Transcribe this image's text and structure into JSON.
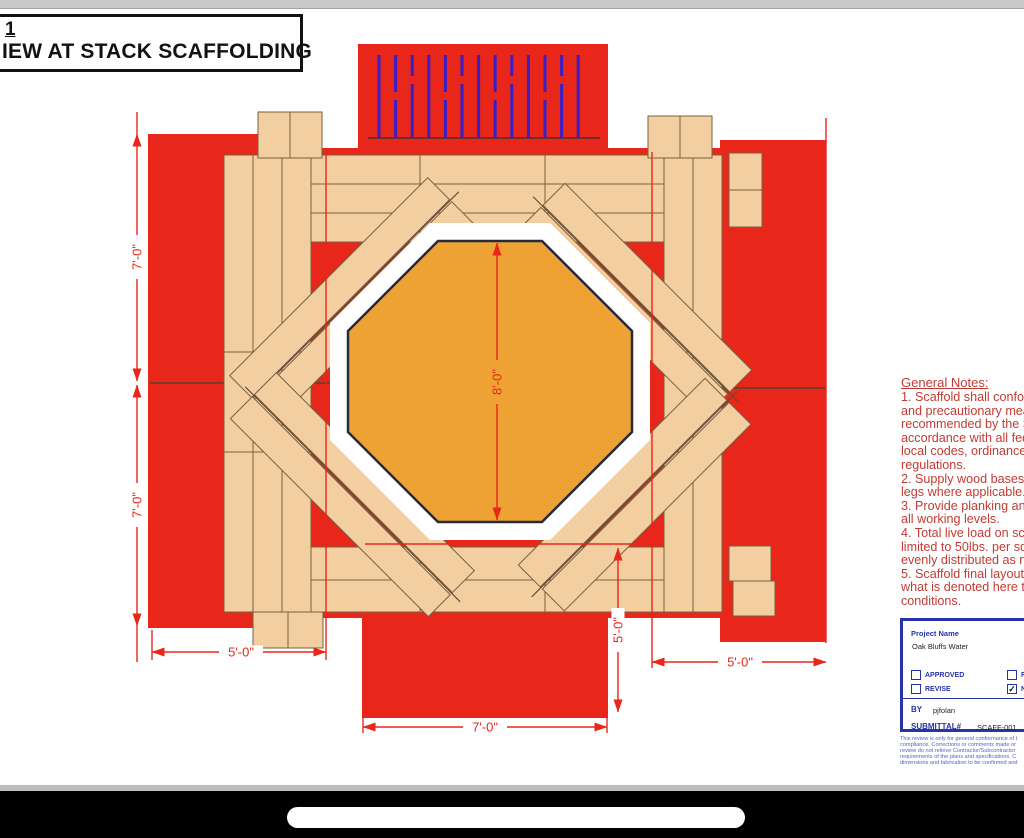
{
  "colors": {
    "scaffold_red": "#E8261A",
    "plank_tan": "#F3CEA1",
    "plank_outline": "#77603F",
    "stack_orange": "#EDA233",
    "stack_outline": "#252A3C",
    "ladder_blue": "#3A1FC4",
    "dimension_red": "#E8261A",
    "notes_red": "#C23B33",
    "submittal_blue": "#2733A6",
    "disclaimer_blue": "#555FC9"
  },
  "title_block": {
    "detail_number": "1",
    "view_title": "IEW AT STACK SCAFFOLDING"
  },
  "drawing": {
    "dimensions": {
      "left_upper": "7'-0\"",
      "left_lower": "7'-0\"",
      "stack_width": "8'-0\"",
      "bottom_left": "5'-0\"",
      "bottom_center": "7'-0\"",
      "bottom_right": "5'-0\"",
      "right_vertical": "5'-0\""
    }
  },
  "general_notes": {
    "title": "General Notes:",
    "lines": [
      "1. Scaffold shall conform",
      "and precautionary meas",
      "recommended by the S",
      "accordance with all fede",
      "local codes, ordinances",
      "regulations.",
      "2. Supply wood bases a",
      "legs where applicable.",
      "3. Provide planking and",
      "all working levels.",
      "4. Total live load on sca",
      "limited to 50lbs. per squ",
      "evenly distributed as ne",
      "5. Scaffold final layout r",
      "what is denoted here to",
      "conditions."
    ]
  },
  "submittal_block": {
    "project_name_label": "Project Name",
    "project_name_value": "Oak Bluffs Water",
    "checkbox_approved": "APPROVED",
    "checkbox_revise": "REVISE",
    "checkbox_rejected_fragment": "R",
    "checkbox_no_exceptions_fragment": "N",
    "check_glyph": "✓",
    "by_label": "BY",
    "by_value": "pjfolan",
    "submittal_label": "SUBMITTAL#",
    "submittal_value": "SCAFF-001",
    "disclaimer_lines": [
      "This review is only for general conformance of t",
      "compliance.  Corrections or comments made or",
      "review do not relieve Contractor/Subcontractor",
      "requirements of the plans and specifications.  C",
      "dimensions and fabrication to be confirmed and"
    ]
  }
}
